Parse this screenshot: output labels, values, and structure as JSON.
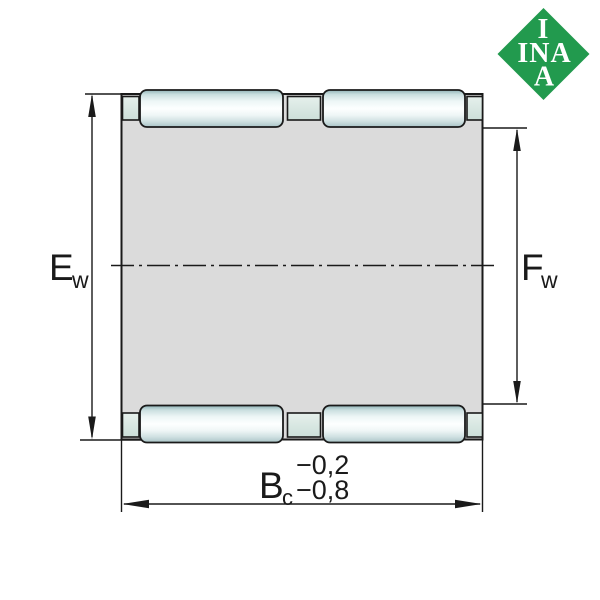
{
  "drawing": {
    "name": "needle-roller-and-cage-assembly-cross-section",
    "dimensions": {
      "left": {
        "label": "E",
        "subscript": "w"
      },
      "right": {
        "label": "F",
        "subscript": "w"
      },
      "bottom": {
        "label": "B",
        "subscript": "c",
        "tolerance_upper": "−0,2",
        "tolerance_lower": "−0,8"
      }
    }
  },
  "logo": {
    "top": "I",
    "middle": "INA",
    "bottom": "A",
    "color": "#229A4E",
    "text_color": "#FFFFFF"
  },
  "colors": {
    "background": "#FFFFFF",
    "cage_body": "#DBDBDB",
    "outline": "#1A1A1A",
    "roller_edge": "#8FB2B6",
    "roller_center": "#FDFFFF",
    "crossbar": "#D8E7E1"
  }
}
